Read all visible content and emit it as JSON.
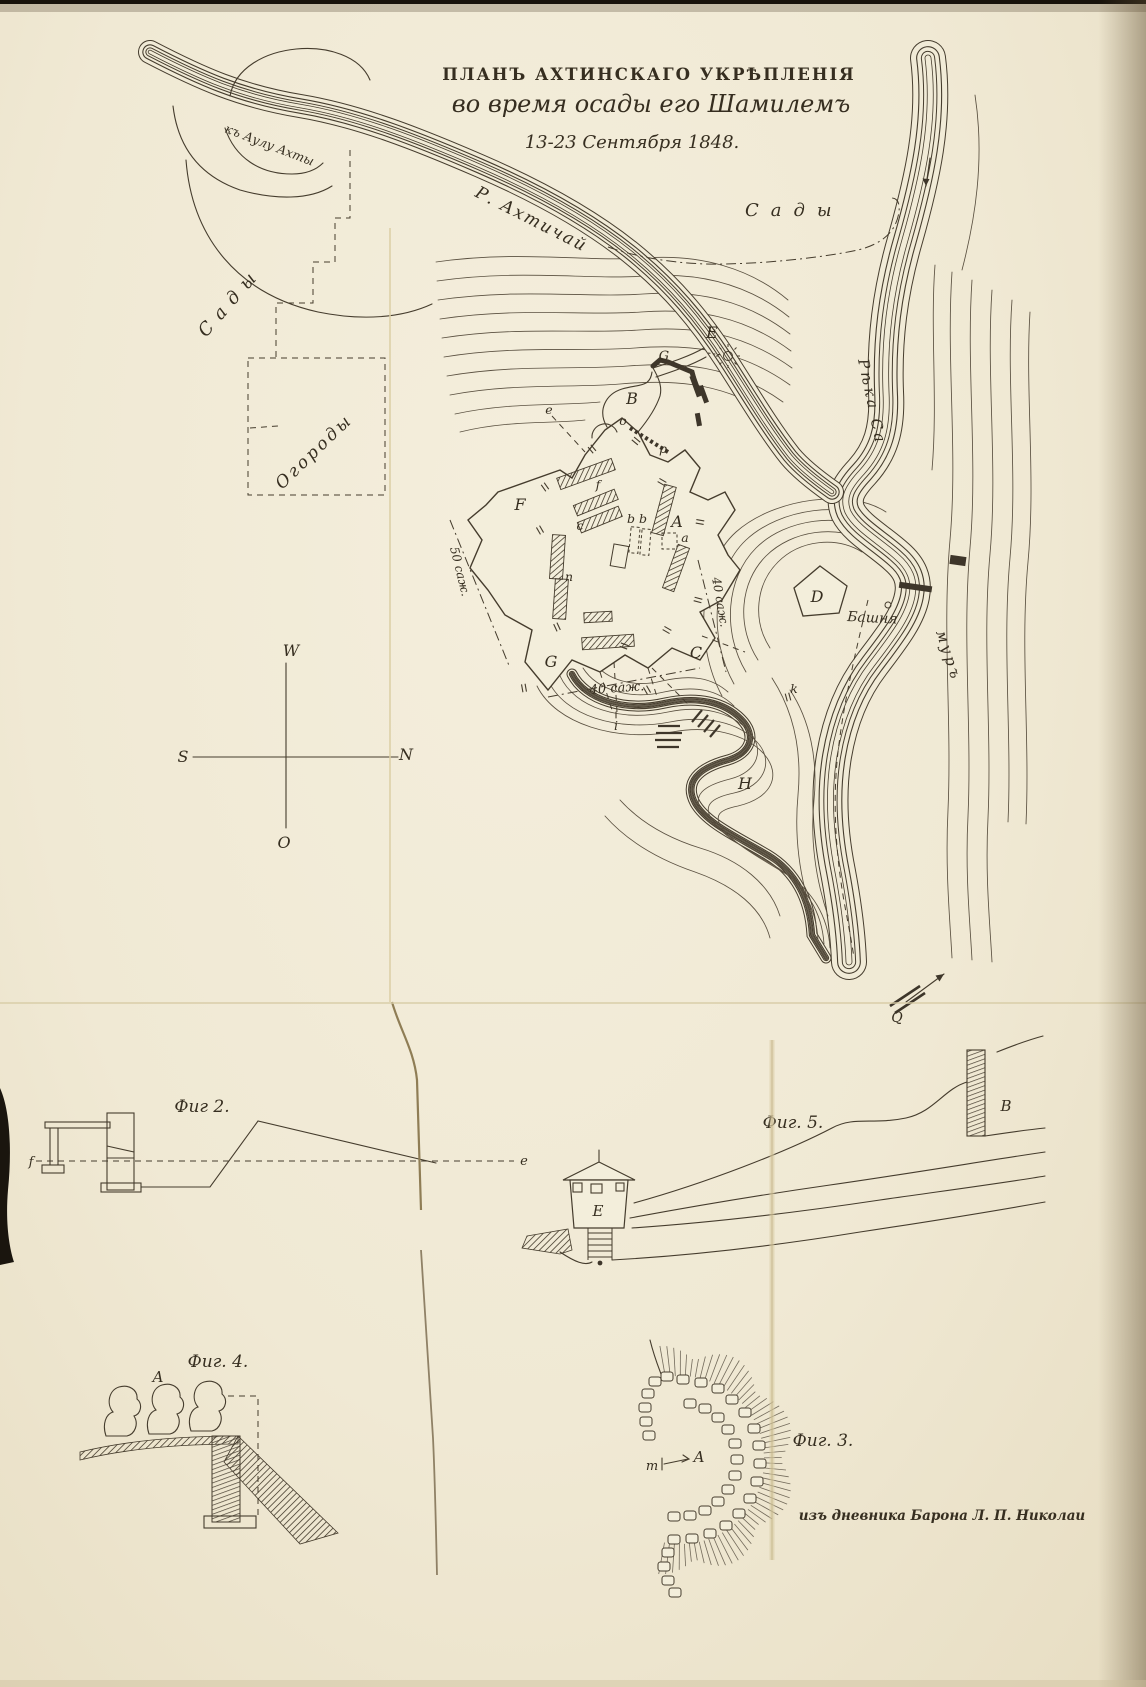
{
  "title": {
    "line1": "ПЛАНЪ АХТИНСКАГО УКРѢПЛЕНІЯ",
    "line2": "во время осады его Шамилемъ",
    "line3": "13-23 Сентября 1848."
  },
  "map_labels": {
    "road_to_aul": "къ Аулу Ахты",
    "river_akhtychay": "Р. Ахтичай",
    "gardens_right": "Сады",
    "gardens_left": "Сады",
    "vegetable_gardens": "Огороды",
    "samur_upper": "Рѣка Са",
    "samur_lower": "муръ",
    "tower": "Башня"
  },
  "compass": {
    "w": "W",
    "s": "S",
    "n": "N",
    "o": "O"
  },
  "distances": {
    "d50": "50 саж.",
    "d40_side": "40 саж.",
    "d40_bottom": "40 саж."
  },
  "fort_letters": {
    "E": "E",
    "G_top": "G",
    "B": "B",
    "o": "o",
    "p": "p",
    "e": "e",
    "F": "F",
    "f": "f",
    "c": "c",
    "bb": "b b",
    "A": "A",
    "a": "a",
    "n": "n",
    "G": "G",
    "C": "C",
    "D": "D",
    "H": "H",
    "i": "i",
    "k": "k",
    "Q": "Q"
  },
  "figures": {
    "fig2": {
      "label": "Фиг 2.",
      "f": "f",
      "e": "e"
    },
    "fig3": {
      "label": "Фиг. 3.",
      "m": "m",
      "A": "A"
    },
    "fig4": {
      "label": "Фиг. 4.",
      "A": "A"
    },
    "fig5": {
      "label": "Фиг. 5.",
      "B": "B",
      "E": "E"
    }
  },
  "attribution": "изъ дневника Барона Л. П. Николаи",
  "colors": {
    "paper": "#f1ebd7",
    "ink": "#3a3226",
    "crease": "#8f7d55"
  }
}
